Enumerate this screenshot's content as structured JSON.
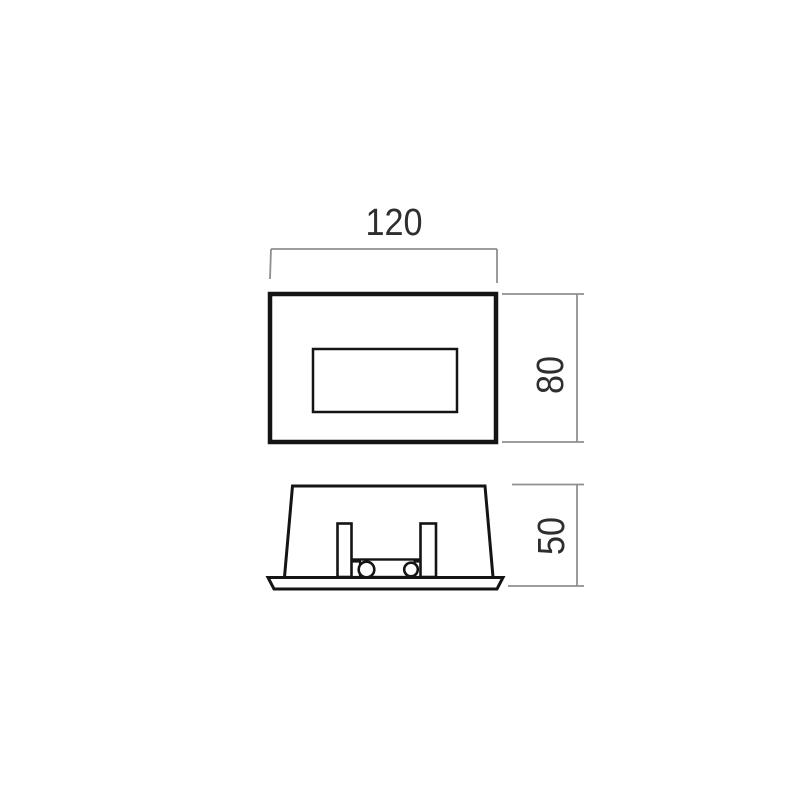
{
  "diagram": {
    "kind": "technical dimension drawing",
    "views": [
      {
        "id": "front-view",
        "description": "front elevation of rectangular recessed fixture with inner window"
      },
      {
        "id": "side-view",
        "description": "side section with mounting flange and spring clips"
      }
    ]
  },
  "dimensions": {
    "width": {
      "value": "120",
      "orientation": "horizontal",
      "applies_to": "front-view overall width"
    },
    "height": {
      "value": "80",
      "orientation": "vertical",
      "applies_to": "front-view overall height"
    },
    "depth": {
      "value": "50",
      "orientation": "vertical",
      "applies_to": "side-view overall depth"
    }
  },
  "colors": {
    "background": "#ffffff",
    "drawing_line": "#141414",
    "dimension_line": "#8f8f8f",
    "label_text": "#2e2e2e"
  }
}
